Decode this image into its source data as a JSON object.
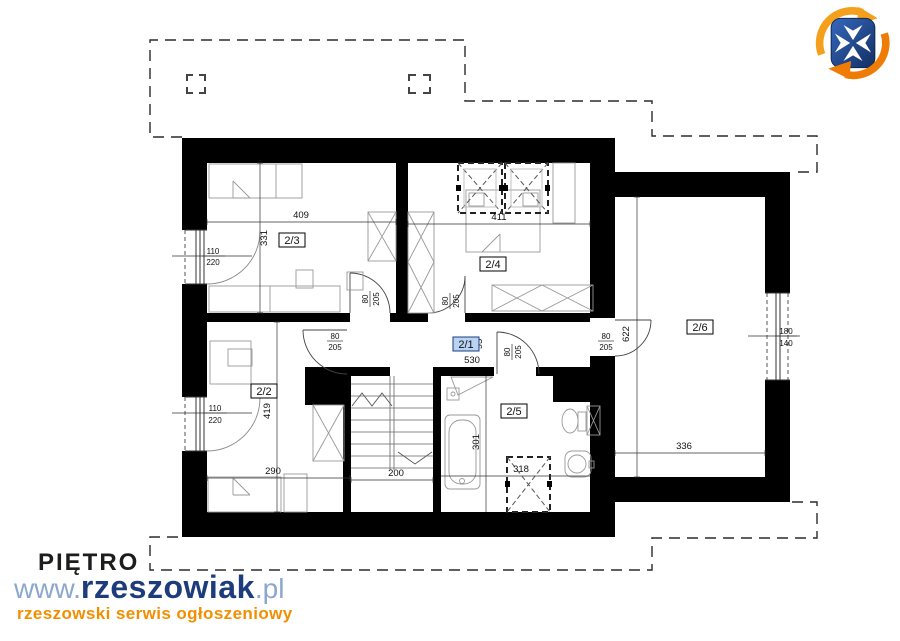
{
  "floor_title": "PIĘTRO",
  "watermark": {
    "www_prefix": "www.",
    "brand": "rzeszowiak",
    "tld": ".pl",
    "tagline": "rzeszowski serwis ogłoszeniowy",
    "logo": "rzeszowiak-shield-logo"
  },
  "colors": {
    "wall": "#000000",
    "furniture_line": "#999999",
    "dimension_line": "#333333",
    "selected_room_bg": "#b8d4f2",
    "brand_navy": "#1d3c7c",
    "brand_light_blue": "#8ba7cd",
    "brand_orange": "#f18f01"
  },
  "plan": {
    "rooms": [
      {
        "label": "2/1",
        "length": "530",
        "width": "95",
        "selected": true
      },
      {
        "label": "2/2",
        "width": "290",
        "height": "419"
      },
      {
        "label": "2/3",
        "width": "409",
        "height": "331"
      },
      {
        "label": "2/4",
        "width": "411"
      },
      {
        "label": "2/5",
        "width": "318",
        "height": "301"
      },
      {
        "label": "2/6",
        "width": "336",
        "height": "622"
      }
    ],
    "stairs": {
      "width": "200"
    },
    "openings": [
      {
        "name": "window-room-2-3",
        "w": "110",
        "h": "220"
      },
      {
        "name": "window-room-2-2",
        "w": "110",
        "h": "220"
      },
      {
        "name": "door-room-2-3",
        "w": "80",
        "h": "205"
      },
      {
        "name": "door-room-2-4",
        "w": "80",
        "h": "205"
      },
      {
        "name": "door-room-2-2",
        "w": "80",
        "h": "205"
      },
      {
        "name": "door-room-2-5",
        "w": "80",
        "h": "205"
      },
      {
        "name": "door-room-2-6",
        "w": "80",
        "h": "205"
      },
      {
        "name": "window-room-2-6",
        "w": "180",
        "h": "140"
      }
    ]
  }
}
